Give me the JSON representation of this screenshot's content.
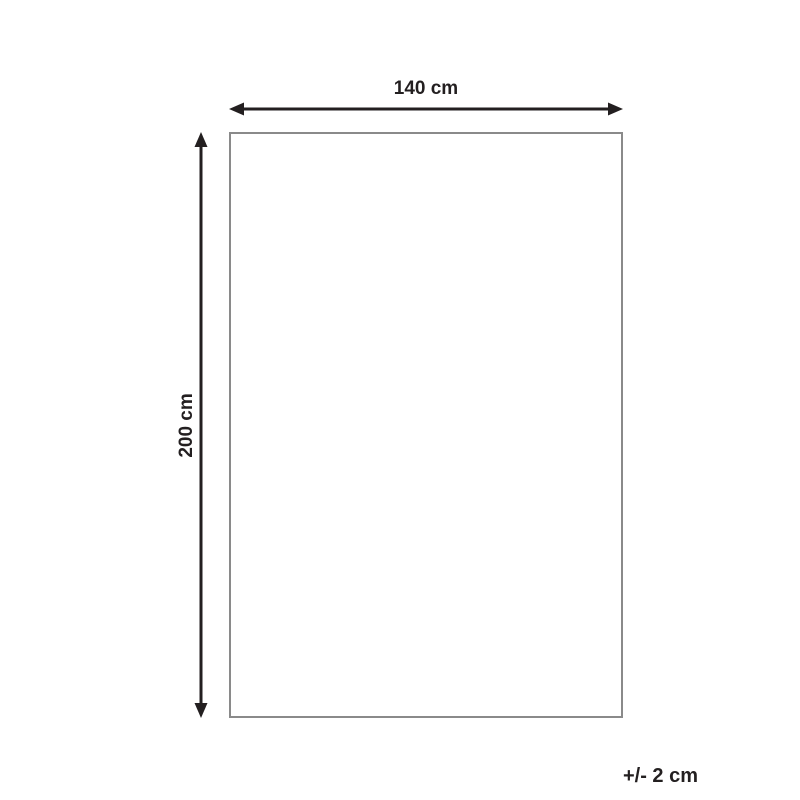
{
  "diagram": {
    "width_label": "140 cm",
    "height_label": "200 cm",
    "tolerance_label": "+/- 2 cm"
  },
  "colors": {
    "line": "#231f20",
    "rect_border": "#8a8a8a",
    "background": "#ffffff"
  }
}
